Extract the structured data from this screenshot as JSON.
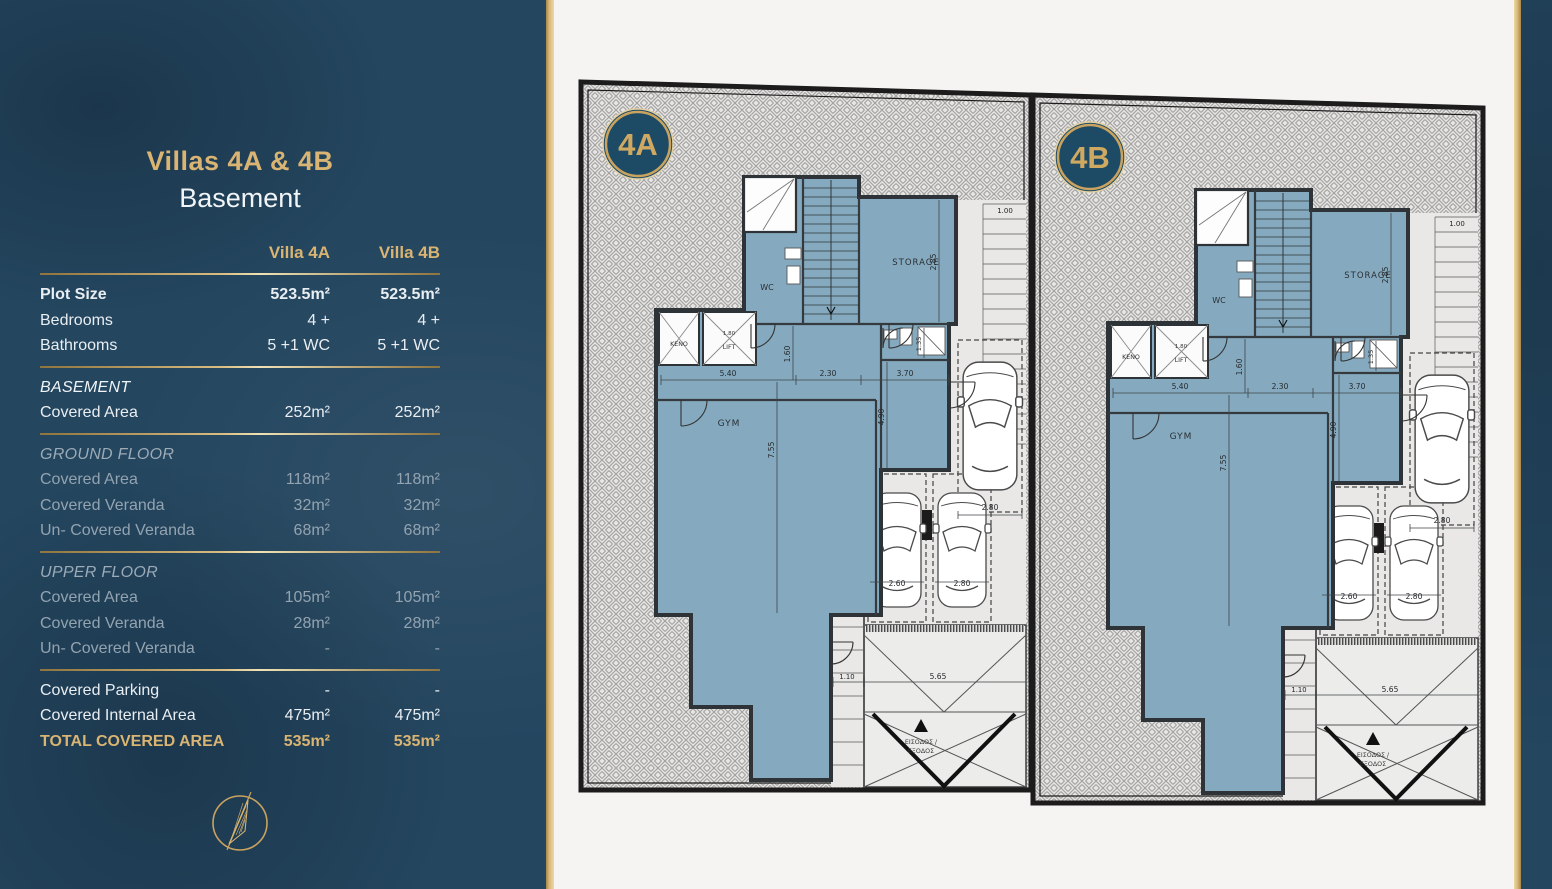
{
  "panel": {
    "title": "Villas 4A & 4B",
    "subtitle": "Basement",
    "columns": [
      "Villa 4A",
      "Villa 4B"
    ],
    "rows": [
      {
        "label": "Plot Size",
        "a": "523.5m²",
        "b": "523.5m²",
        "style": "bold"
      },
      {
        "label": "Bedrooms",
        "a": "4 +",
        "b": "4 +",
        "style": "normal"
      },
      {
        "label": "Bathrooms",
        "a": "5 +1 WC",
        "b": "5 +1 WC",
        "style": "normal",
        "divider_after": true
      },
      {
        "label": "BASEMENT",
        "a": "",
        "b": "",
        "style": "section-active"
      },
      {
        "label": "Covered Area",
        "a": "252m²",
        "b": "252m²",
        "style": "normal",
        "divider_after": true
      },
      {
        "label": "GROUND FLOOR",
        "a": "",
        "b": "",
        "style": "section"
      },
      {
        "label": "Covered Area",
        "a": "118m²",
        "b": "118m²",
        "style": "dim"
      },
      {
        "label": "Covered Veranda",
        "a": "32m²",
        "b": "32m²",
        "style": "dim"
      },
      {
        "label": "Un- Covered Veranda",
        "a": "68m²",
        "b": "68m²",
        "style": "dim",
        "divider_after": true
      },
      {
        "label": "UPPER FLOOR",
        "a": "",
        "b": "",
        "style": "section"
      },
      {
        "label": "Covered Area",
        "a": "105m²",
        "b": "105m²",
        "style": "dim"
      },
      {
        "label": "Covered Veranda",
        "a": "28m²",
        "b": "28m²",
        "style": "dim"
      },
      {
        "label": "Un- Covered Veranda",
        "a": "-",
        "b": "-",
        "style": "dim",
        "divider_after": true
      },
      {
        "label": "Covered Parking",
        "a": "-",
        "b": "-",
        "style": "normal"
      },
      {
        "label": "Covered Internal Area",
        "a": "475m²",
        "b": "475m²",
        "style": "normal"
      },
      {
        "label": "TOTAL COVERED AREA",
        "a": "535m²",
        "b": "535m²",
        "style": "total"
      }
    ]
  },
  "plan": {
    "badges": [
      "4A",
      "4B"
    ],
    "labels": {
      "keno": "ΚΕΝΟ",
      "lift": "LIFT",
      "wc": "WC",
      "storage": "STORAGE",
      "gym": "GYM",
      "entrance_1": "ΕΙΣΟΔΟΣ /",
      "entrance_2": "ΕΞΟΔΟΣ"
    },
    "dimensions": {
      "gym_width": "5.40",
      "hall_width": "2.30",
      "room_width": "3.70",
      "gym_height": "7.55",
      "room_height": "4.90",
      "hall_height": "1.60",
      "bath_height": "1.35",
      "storage_height": "2.85",
      "lift_width": "1.80",
      "parking_top": "2.80",
      "parking_left": "2.60",
      "parking_right": "2.80",
      "ramp_side": "1.10",
      "ramp_width": "5.65",
      "stair_width": "1.00"
    },
    "colors": {
      "room_fill": "#85aabf",
      "wall": "#2e3337",
      "driveway": "#e9e8e6",
      "hatch_line": "#a3a3a1",
      "badge_bg": "#1d4b66",
      "gold": "#c9a35f"
    }
  }
}
